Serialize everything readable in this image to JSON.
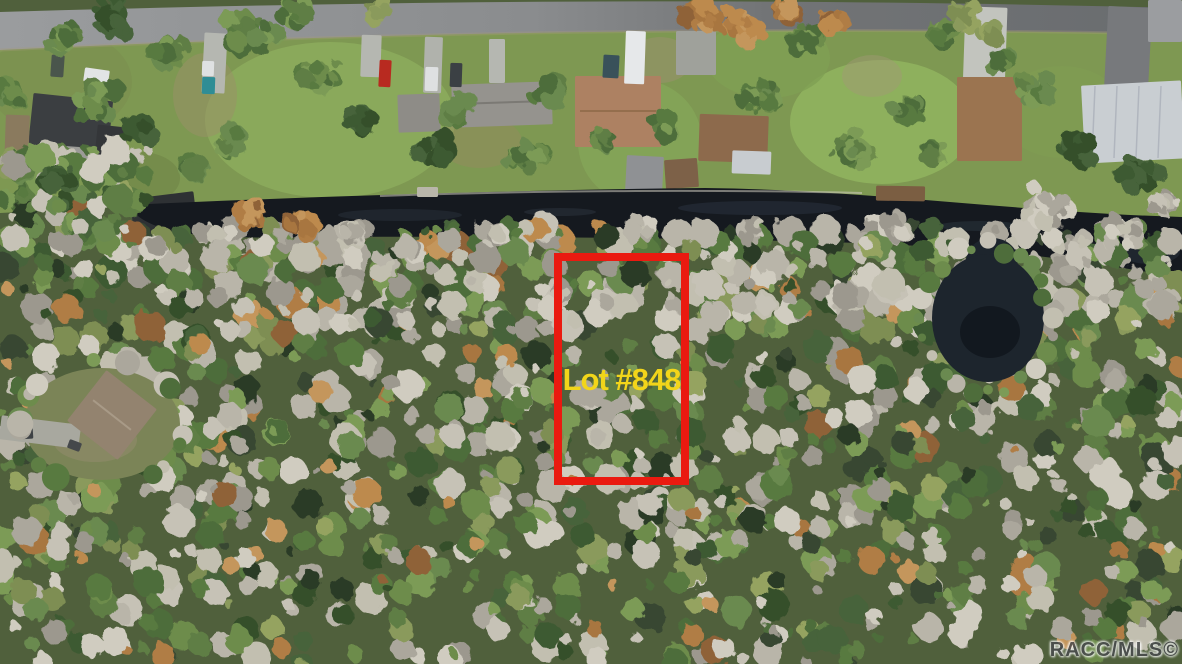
{
  "annotation": {
    "lot_label": "Lot #848",
    "box": {
      "x": 554,
      "y": 253,
      "width": 135,
      "height": 232,
      "border_px": 8
    },
    "outline_color": "#ea1a10",
    "label_color": "#f2d51a"
  },
  "watermark": {
    "text": "RACC/MLS©",
    "color": "#4a4c4e"
  },
  "scene": {
    "size": {
      "w": 1182,
      "h": 664
    },
    "colors": {
      "forest_base": "#50603c",
      "grass": "#7e9852",
      "water": "#15191f",
      "pond_fill": "#1d252d",
      "shoulder": "#a59a7a",
      "seawall": "#cfccc0"
    },
    "road": {
      "path": "M0,12 C 350,2 700,-4 1182,8 L1182,34 C 760,26 380,32 0,50 Z",
      "shoulder_path": "M0,50 C 380,32 760,26 1182,34",
      "gradient": [
        "#9a9c9e",
        "#8a8c8e",
        "#727476",
        "#696c6f"
      ]
    },
    "grass_path": "M0,46 C 380,30 760,24 1182,32 L1182,220 C 1015,214 862,192 705,189 C 520,191 322,197 130,206 C 95,208 40,211 0,213 Z",
    "canal_path": "M128,205 C 320,196 520,190 705,188 C 870,190 1015,212 1182,217 L1182,278 C 1090,262 1020,250 860,243 C 700,238 520,236 330,237 C 230,238 150,241 128,205 Z",
    "water_streaks": [
      [
        400,
        215,
        62,
        6,
        "#2a323c",
        0.5
      ],
      [
        760,
        208,
        82,
        7,
        "#2e3844",
        0.45
      ],
      [
        980,
        226,
        42,
        5,
        "#323e49",
        0.4
      ],
      [
        560,
        212,
        36,
        4,
        "#39434e",
        0.35
      ],
      [
        1150,
        252,
        30,
        12,
        "#272f38",
        0.6
      ]
    ],
    "seawall_path": "M380,196 C 520,191 700,189 862,193",
    "lawns": [
      [
        330,
        120,
        125,
        78,
        "#8cab5c",
        0.9
      ],
      [
        640,
        142,
        62,
        62,
        "#84a458",
        0.9
      ],
      [
        882,
        122,
        92,
        62,
        "#8fb15e",
        0.95
      ],
      [
        768,
        58,
        62,
        40,
        "#7fa054",
        0.8
      ],
      [
        60,
        82,
        72,
        52,
        "#7c9150",
        0.8
      ],
      [
        1062,
        112,
        62,
        46,
        "#7f9c52",
        0.8
      ],
      [
        205,
        95,
        32,
        42,
        "#9a8f68",
        0.5
      ],
      [
        480,
        142,
        42,
        26,
        "#96895f",
        0.45
      ],
      [
        660,
        60,
        32,
        23,
        "#9b9070",
        0.5
      ],
      [
        872,
        76,
        30,
        21,
        "#a29a75",
        0.45
      ],
      [
        140,
        178,
        40,
        26,
        "#6f8447",
        0.6
      ]
    ],
    "driveways": [
      [
        "driveway-1",
        203,
        33,
        23,
        60,
        3,
        "#b5b7b1"
      ],
      [
        "driveway-2",
        361,
        35,
        20,
        42,
        2,
        "#b5b7b1"
      ],
      [
        "driveway-3",
        424,
        37,
        18,
        56,
        2,
        "#b0b2ac"
      ],
      [
        "driveway-4",
        489,
        39,
        16,
        44,
        0,
        "#b5b7b1"
      ],
      [
        "driveway-pad",
        676,
        31,
        40,
        44,
        0,
        "#9fa19b"
      ],
      [
        "driveway-long",
        964,
        7,
        42,
        86,
        2,
        "#c2c4be"
      ],
      [
        "driveway-asphalt",
        1106,
        7,
        44,
        88,
        3,
        "#77797c"
      ],
      [
        "road-patch-corner",
        1148,
        0,
        34,
        42,
        0,
        "#9b9da0"
      ]
    ],
    "houses": [
      [
        "house-black-roof-left",
        30,
        97,
        80,
        64,
        6,
        "#3b3e41"
      ],
      [
        "house-black-roof-left-wing",
        96,
        126,
        30,
        34,
        6,
        "#343639"
      ],
      [
        "shed-tan-left",
        5,
        115,
        24,
        52,
        2,
        "#8a7a5e"
      ],
      [
        "shed-gray-left",
        63,
        147,
        33,
        20,
        4,
        "#9b9b97"
      ],
      [
        "boathouse-left",
        132,
        195,
        64,
        40,
        -7,
        "#2e3134"
      ],
      [
        "house-gray-small",
        398,
        94,
        42,
        38,
        -2,
        "#8e8c87"
      ],
      [
        "house-gray-long",
        452,
        83,
        100,
        43,
        -2,
        "#95938e"
      ],
      [
        "house-tan-mid",
        575,
        76,
        86,
        71,
        0,
        "#ad8162"
      ],
      [
        "boathouse-gray",
        626,
        156,
        37,
        35,
        3,
        "#8f9194"
      ],
      [
        "boathouse-brown",
        665,
        159,
        33,
        29,
        -4,
        "#7d6148"
      ],
      [
        "house-brown-mid",
        699,
        115,
        69,
        47,
        2,
        "#8d6a4c"
      ],
      [
        "porch-white-mid",
        732,
        151,
        39,
        23,
        2,
        "#c8ccd0"
      ],
      [
        "house-brown-right",
        957,
        77,
        65,
        84,
        0,
        "#9b7450"
      ],
      [
        "house-metal-right",
        1083,
        83,
        100,
        78,
        -3,
        "#c9ced2"
      ]
    ],
    "docks": [
      [
        "dock-brown",
        876,
        186,
        49,
        15,
        1,
        "#7b5e42"
      ],
      [
        "dock-small",
        417,
        187,
        21,
        10,
        0,
        "#b9b6aa"
      ]
    ],
    "vehicles": [
      [
        "car-white-left",
        84,
        69,
        25,
        14,
        8,
        "#e2e4e5"
      ],
      [
        "car-green-left",
        51,
        55,
        13,
        22,
        4,
        "#4a554c"
      ],
      [
        "truck-white",
        202,
        61,
        12,
        15,
        2,
        "#dfe1e2"
      ],
      [
        "boat-teal",
        202,
        77,
        13,
        17,
        2,
        "#2f8d95"
      ],
      [
        "car-red",
        379,
        60,
        12,
        27,
        3,
        "#b82a20"
      ],
      [
        "car-white-2",
        425,
        67,
        13,
        24,
        2,
        "#dee0e1"
      ],
      [
        "car-dark",
        450,
        63,
        12,
        24,
        2,
        "#3b4044"
      ],
      [
        "rv-white",
        625,
        31,
        20,
        53,
        2,
        "#e6e8ea"
      ],
      [
        "truck-dark-teal",
        603,
        55,
        16,
        23,
        3,
        "#39515a"
      ]
    ],
    "pond": {
      "cx": 988,
      "cy": 318,
      "rx": 56,
      "ry": 64,
      "fill": "#1d252d",
      "connector": {
        "cx": 992,
        "cy": 260,
        "rx": 26,
        "ry": 22
      },
      "dark": {
        "cx": 990,
        "cy": 332,
        "rx": 30,
        "ry": 26,
        "fill": "#10151b"
      },
      "rim_count": 24
    },
    "clearing": {
      "cx": 102,
      "cy": 424,
      "rx": 78,
      "ry": 56,
      "fill": "#7b8457",
      "dirt": [
        95,
        440,
        42,
        22,
        "#8f8a68"
      ],
      "driveway": [
        0,
        420,
        80,
        24,
        7,
        "#a8a89f"
      ],
      "house": [
        "house-bottom-left",
        80,
        383,
        64,
        64,
        38,
        "#93836f"
      ],
      "cars": [
        [
          "car-dark-clearing",
          18,
          428,
          15,
          11,
          -4,
          "#3e4245"
        ],
        [
          "car-dark-clearing-2",
          68,
          441,
          13,
          9,
          20,
          "#45484b"
        ]
      ]
    },
    "palettes": {
      "pale": [
        "#b9b5a9",
        "#c6c2b6",
        "#aba79c",
        "#d0ccc0",
        "#9c988e",
        "#c2bfb0"
      ],
      "green": [
        "#5e7e44",
        "#4e6d3b",
        "#6d8c4c",
        "#7c9b57",
        "#587a40",
        "#6a8a50"
      ],
      "darkgreen": [
        "#3e5a32",
        "#46643a",
        "#35502c"
      ],
      "olive": [
        "#8a9a5c",
        "#95a360",
        "#7e8e52"
      ],
      "rust": [
        "#a8763f",
        "#bd8a4e",
        "#8f6239",
        "#b07d45",
        "#c4965c"
      ],
      "dark": [
        "#2c3a28",
        "#374733"
      ]
    },
    "clusters_green": [
      [
        112,
        18,
        26
      ],
      [
        168,
        52,
        20
      ],
      [
        255,
        33,
        30
      ],
      [
        318,
        74,
        22
      ],
      [
        298,
        14,
        18
      ],
      [
        362,
        120,
        17
      ],
      [
        432,
        150,
        20
      ],
      [
        457,
        110,
        16
      ],
      [
        522,
        160,
        22
      ],
      [
        546,
        90,
        18
      ],
      [
        606,
        140,
        14
      ],
      [
        662,
        122,
        16
      ],
      [
        762,
        95,
        20
      ],
      [
        802,
        40,
        18
      ],
      [
        852,
        150,
        22
      ],
      [
        906,
        110,
        16
      ],
      [
        932,
        152,
        14
      ],
      [
        1036,
        90,
        18
      ],
      [
        1078,
        150,
        20
      ],
      [
        942,
        30,
        14
      ],
      [
        1002,
        60,
        12
      ],
      [
        1142,
        172,
        22
      ],
      [
        60,
        40,
        18
      ],
      [
        10,
        92,
        16
      ],
      [
        96,
        100,
        25
      ],
      [
        142,
        130,
        18
      ],
      [
        230,
        140,
        16
      ],
      [
        195,
        170,
        14
      ],
      [
        58,
        180,
        16
      ]
    ],
    "clusters_rust": [
      [
        706,
        14,
        22
      ],
      [
        746,
        28,
        18
      ],
      [
        786,
        12,
        16
      ],
      [
        830,
        20,
        12
      ],
      [
        250,
        215,
        16
      ],
      [
        300,
        225,
        14
      ]
    ],
    "clusters_yellow": [
      [
        966,
        18,
        16
      ],
      [
        988,
        32,
        12
      ],
      [
        376,
        12,
        10
      ]
    ],
    "clusters_pale": [
      [
        1048,
        208,
        26
      ],
      [
        898,
        228,
        16
      ],
      [
        756,
        232,
        14
      ],
      [
        642,
        230,
        12
      ],
      [
        352,
        231,
        14
      ],
      [
        492,
        233,
        12
      ],
      [
        1122,
        232,
        20
      ],
      [
        1166,
        206,
        16
      ],
      [
        210,
        232,
        12
      ]
    ],
    "forest": {
      "seed": 7,
      "count_main": 1200,
      "count_band": 260,
      "count_left": 90,
      "main_region": [
        0,
        226,
        1182,
        664
      ],
      "band_region": [
        150,
        226,
        1182,
        330
      ],
      "left_region": [
        0,
        148,
        150,
        245
      ]
    }
  }
}
